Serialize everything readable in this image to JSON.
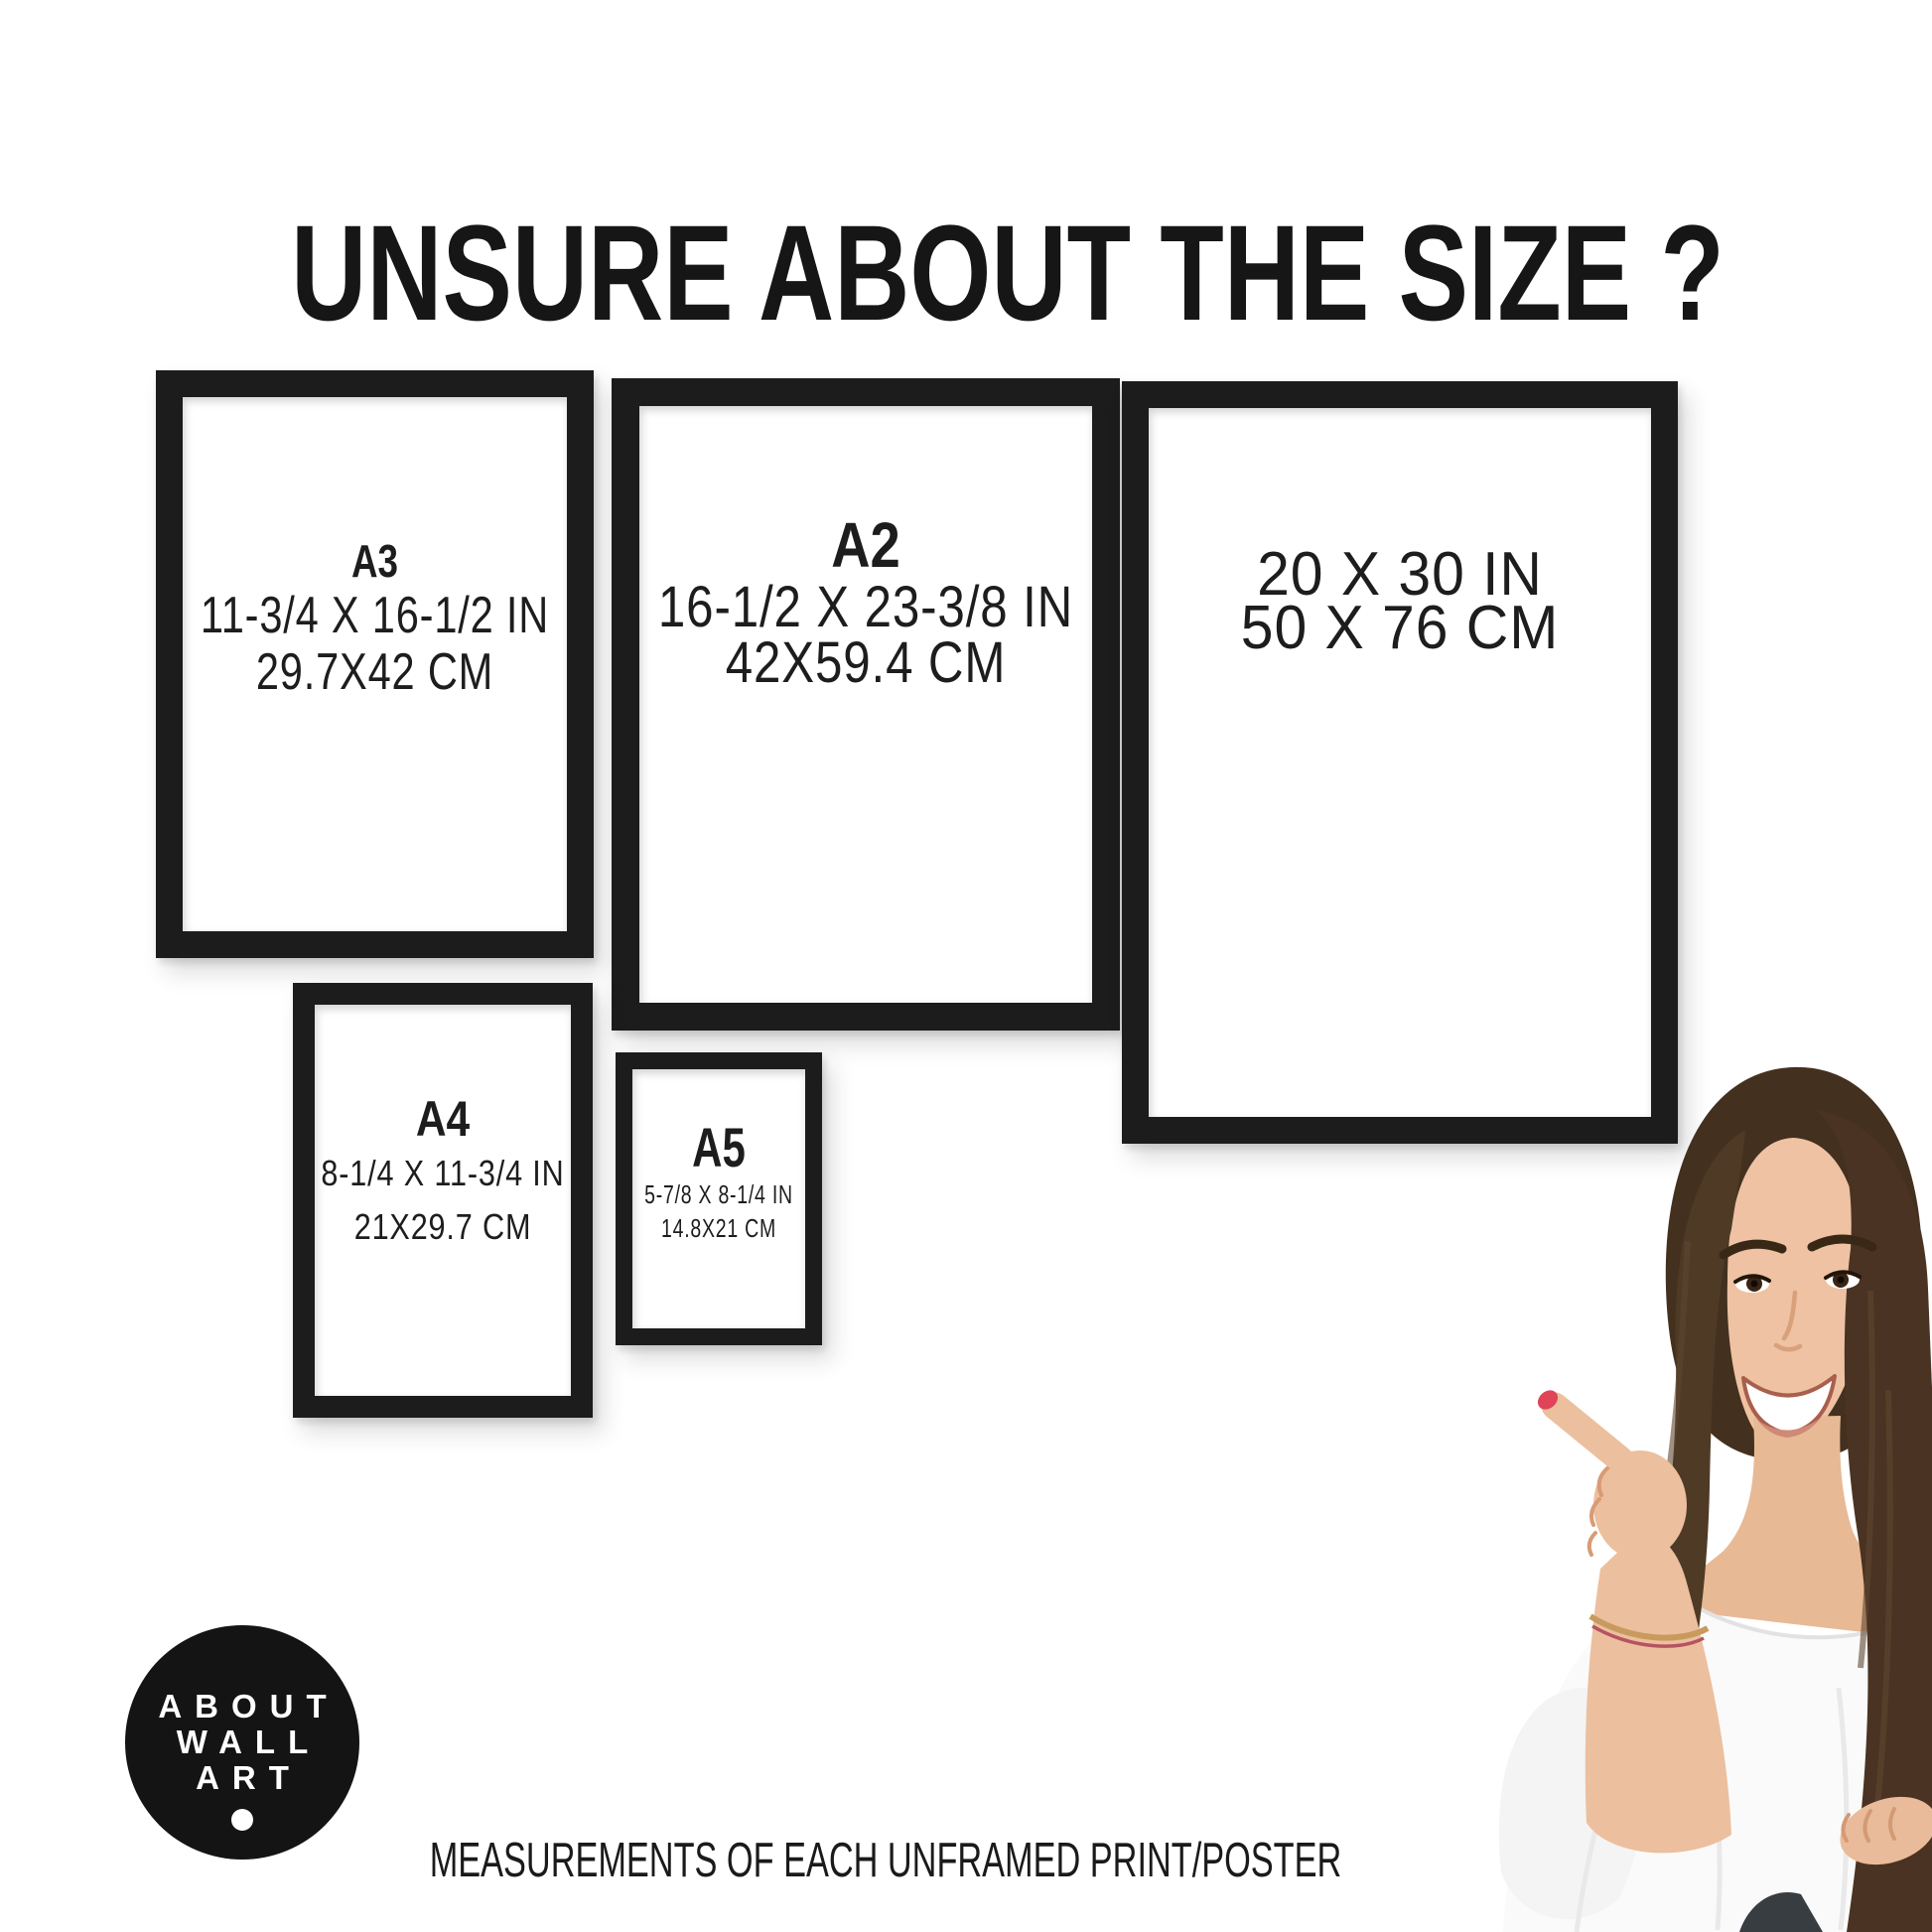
{
  "header": {
    "title": "UNSURE ABOUT THE SIZE ?"
  },
  "frames": [
    {
      "name": "A3",
      "inches": "11-3/4 X 16-1/2 IN",
      "cm": "29.7X42 CM"
    },
    {
      "name": "A2",
      "inches": "16-1/2 X 23-3/8 IN",
      "cm": "42X59.4 CM"
    },
    {
      "name": "",
      "inches": "20 X 30 IN",
      "cm": "50 X 76 CM"
    },
    {
      "name": "A4",
      "inches": "8-1/4 X 11-3/4 IN",
      "cm": "21X29.7 CM"
    },
    {
      "name": "A5",
      "inches": "5-7/8 X 8-1/4 IN",
      "cm": "14.8X21 CM"
    }
  ],
  "logo": {
    "line1": "ABOUT",
    "line2": "WALL",
    "line3": "ART"
  },
  "footer": {
    "caption": "MEASUREMENTS OF EACH UNFRAMED PRINT/POSTER"
  },
  "colors": {
    "frame_black": "#1c1c1c",
    "text_black": "#1d1d1d",
    "logo_black": "#141414",
    "nail_red": "#e04458",
    "hair_brown": "#4a3322",
    "skin": "#eec2a2",
    "background": "#ffffff"
  }
}
